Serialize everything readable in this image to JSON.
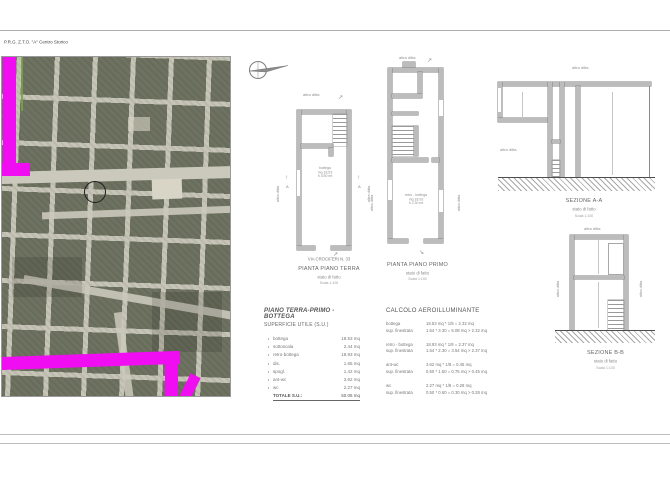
{
  "header": {
    "zone_label": "P.R.G. Z.T.O. \"A\" Centro Storico"
  },
  "colors": {
    "highlight": "#f10df1",
    "wall": "#bcbcbc",
    "map_block": "#6e7260",
    "map_street": "#c7c5b7"
  },
  "icons": {
    "north_arrow": "compass-north-arrow",
    "cut_arrow_up": "↑",
    "cut_arrow_ne": "↗",
    "cut_arrow_se": "↘"
  },
  "plan_terra": {
    "neighbor_top": "altra ditta",
    "neighbor_left": "altra ditta",
    "neighbor_right": "altra ditta",
    "cut_letter": "A",
    "room": {
      "name": "bottega",
      "area": "mq 18.53",
      "height": "h 3.50 mt"
    },
    "street": "VIA CROCIFERI N. 33",
    "title": "PIANTA PIANO TERRA",
    "state": "stato di fatto",
    "scale": "Scala 1:100"
  },
  "plan_primo": {
    "neighbor_top": "altra ditta",
    "neighbor_left": "altra ditta",
    "neighbor_right": "altra ditta",
    "room": {
      "name": "retro - bottega",
      "area": "mq 18.93",
      "height": "h 2.30 mt"
    },
    "title": "PIANTA PIANO PRIMO",
    "state": "stato di fatto",
    "scale": "Scala 1:100"
  },
  "section_aa": {
    "neighbor_top": "altra ditta",
    "neighbor_left": "altra ditta",
    "title": "SEZIONE A-A",
    "state": "stato di fatto",
    "scale": "Scala 1:100"
  },
  "section_bb": {
    "neighbor_top": "altra ditta",
    "neighbor_left": "altra ditta",
    "neighbor_right": "altra ditta",
    "title": "SEZIONE B-B",
    "state": "stato di fatto",
    "scale": "Scala 1:100"
  },
  "surface_table": {
    "title": "PIANO TERRA-PRIMO - BOTTEGA",
    "subtitle": "SUPERFICIE UTILE (S.U.)",
    "rows": [
      {
        "label": "bottega",
        "value": "18.53 mq"
      },
      {
        "label": "sottoscala",
        "value": "2.44 mq"
      },
      {
        "label": "retro-bottega",
        "value": "18.93 mq"
      },
      {
        "label": "dis.",
        "value": "1.65 mq"
      },
      {
        "label": "spogl.",
        "value": "1.42 mq"
      },
      {
        "label": "ant-wc",
        "value": "3.62 mq"
      },
      {
        "label": "wc",
        "value": "2.27 mq"
      }
    ],
    "total_label": "TOTALE S.U.:",
    "total_value": "50.06 mq"
  },
  "aero_table": {
    "title": "CALCOLO AEROILLUMINANTE",
    "groups": [
      {
        "label": "bottega",
        "formula": "18.53 mq * 1/8 = 2.32 mq",
        "sup_label": "sup. finestrata",
        "sup_formula": "1.54 * 3.30 =  5.08 mq > 2.32 mq"
      },
      {
        "label": "retro - bottega",
        "formula": "18.93 mq * 1/8 = 2.37 mq",
        "sup_label": "sup. finestrata",
        "sup_formula": "1.54 * 2.30 =  3.54 mq > 2.37 mq"
      },
      {
        "label": "ant-wc",
        "formula": "3.62 mq * 1/8 = 0.45 mq",
        "sup_label": "sup. finestrata",
        "sup_formula": "0.50 * 1.50 =  0.75 mq > 0.45 mq"
      },
      {
        "label": "wc",
        "formula": "2.27 mq * 1/8 = 0.28 mq",
        "sup_label": "sup. finestrata",
        "sup_formula": "0.50 * 0.60 =  0.30 mq > 0.28 mq"
      }
    ]
  }
}
